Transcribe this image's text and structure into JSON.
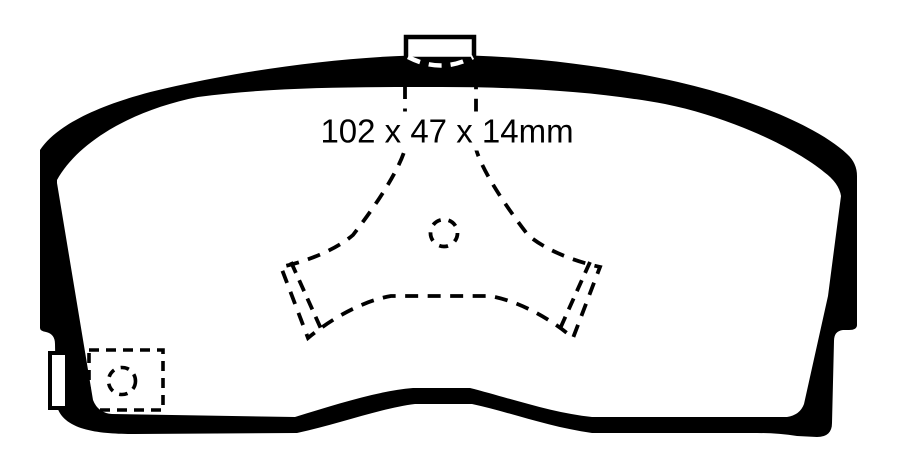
{
  "diagram": {
    "type": "brake-pad-technical-drawing",
    "dimension_label": "102 x 47 x 14mm",
    "dimensions": {
      "width_mm": 102,
      "height_mm": 47,
      "thickness_mm": 14
    },
    "colors": {
      "line": "#000000",
      "background": "#ffffff"
    },
    "features": {
      "top": "mounting-tab",
      "center": "caliper-piston-contact-outline",
      "bottom_left": "wear-sensor-box"
    }
  }
}
